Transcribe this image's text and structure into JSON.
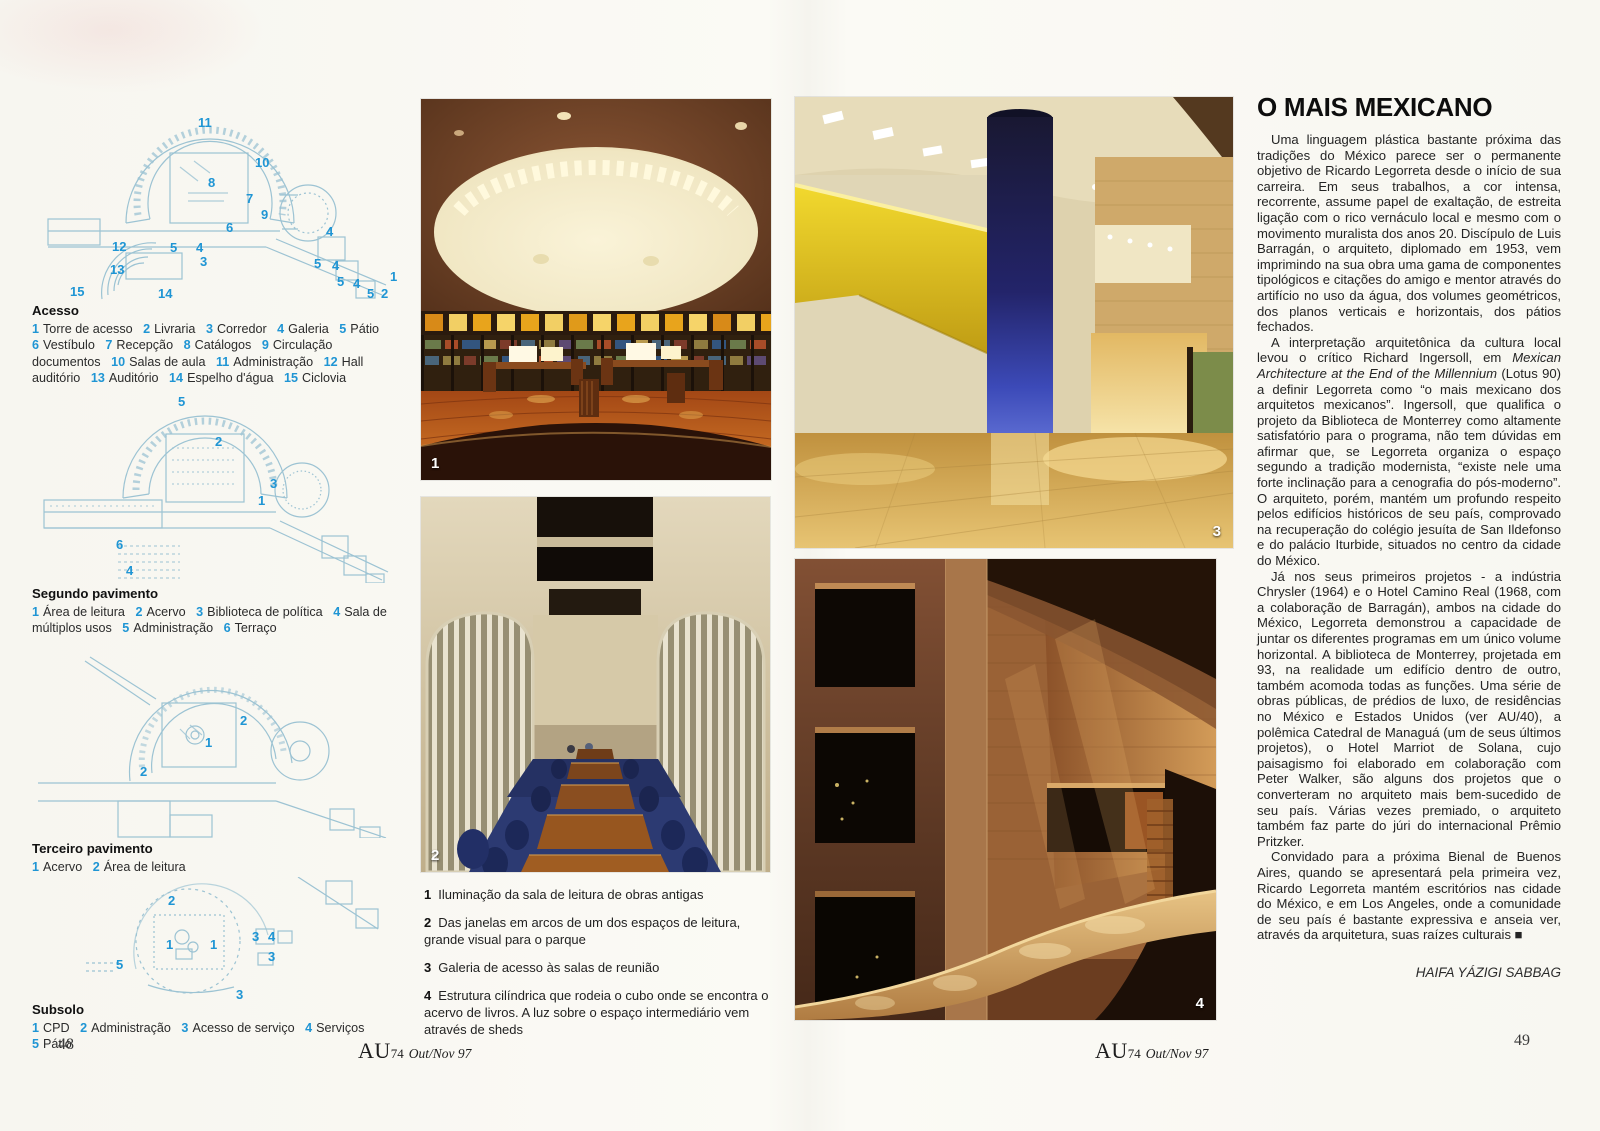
{
  "colors": {
    "legend_number_blue": "#1f95d4",
    "plan_line_blue": "#9cc3d3",
    "accent_yellow": "#e3c321",
    "column_navy": "#23246a",
    "photo_warm_floor": "#d8a75a"
  },
  "left_page": {
    "page_number": "48",
    "plans": [
      {
        "heading": "Acesso",
        "items": [
          {
            "n": "1",
            "label": "Torre de acesso"
          },
          {
            "n": "2",
            "label": "Livraria"
          },
          {
            "n": "3",
            "label": "Corredor"
          },
          {
            "n": "4",
            "label": "Galeria"
          },
          {
            "n": "5",
            "label": "Pátio"
          },
          {
            "n": "6",
            "label": "Vestíbulo"
          },
          {
            "n": "7",
            "label": "Recepção"
          },
          {
            "n": "8",
            "label": "Catálogos"
          },
          {
            "n": "9",
            "label": "Circulação documentos"
          },
          {
            "n": "10",
            "label": "Salas de aula"
          },
          {
            "n": "11",
            "label": "Administração"
          },
          {
            "n": "12",
            "label": "Hall auditório"
          },
          {
            "n": "13",
            "label": "Auditório"
          },
          {
            "n": "14",
            "label": "Espelho d'água"
          },
          {
            "n": "15",
            "label": "Ciclovia"
          }
        ],
        "markers": [
          "11",
          "10",
          "8",
          "7",
          "9",
          "6",
          "12",
          "5",
          "4",
          "3",
          "13",
          "15",
          "14",
          "4",
          "5",
          "4",
          "5",
          "4",
          "5",
          "2",
          "1"
        ]
      },
      {
        "heading": "Segundo pavimento",
        "items": [
          {
            "n": "1",
            "label": "Área de leitura"
          },
          {
            "n": "2",
            "label": "Acervo"
          },
          {
            "n": "3",
            "label": "Biblioteca de política"
          },
          {
            "n": "4",
            "label": "Sala de múltiplos usos"
          },
          {
            "n": "5",
            "label": "Administração"
          },
          {
            "n": "6",
            "label": "Terraço"
          }
        ],
        "markers": [
          "5",
          "2",
          "3",
          "1",
          "6",
          "4"
        ]
      },
      {
        "heading": "Terceiro pavimento",
        "items": [
          {
            "n": "1",
            "label": "Acervo"
          },
          {
            "n": "2",
            "label": "Área de leitura"
          }
        ],
        "markers": [
          "2",
          "1",
          "2"
        ]
      },
      {
        "heading": "Subsolo",
        "items": [
          {
            "n": "1",
            "label": "CPD"
          },
          {
            "n": "2",
            "label": "Administração"
          },
          {
            "n": "3",
            "label": "Acesso de serviço"
          },
          {
            "n": "4",
            "label": "Serviços"
          },
          {
            "n": "5",
            "label": "Pátio"
          }
        ],
        "markers": [
          "2",
          "1",
          "1",
          "3",
          "4",
          "3",
          "5",
          "3"
        ]
      }
    ],
    "photo1_label": "1",
    "photo2_label": "2",
    "captions": [
      {
        "n": "1",
        "text": "Iluminação da sala de leitura de obras antigas"
      },
      {
        "n": "2",
        "text": "Das janelas em arcos de um dos espaços de leitura, grande visual para o parque"
      },
      {
        "n": "3",
        "text": "Galeria de acesso às salas de reunião"
      },
      {
        "n": "4",
        "text": "Estrutura cilíndrica que rodeia o cubo onde se encontra o acervo de livros. A luz sobre o espaço intermediário vem através de sheds"
      }
    ],
    "footer": {
      "logo": "AU",
      "issue": "74",
      "date": "Out/Nov 97"
    }
  },
  "right_page": {
    "page_number": "49",
    "photo3_label": "3",
    "photo4_label": "4",
    "article": {
      "title": "O MAIS MEXICANO",
      "p1": "Uma linguagem plástica bastante próxima das tradições do México parece ser o permanente objetivo de Ricardo Legorreta desde o início de sua carreira. Em seus trabalhos, a cor intensa, recorrente, assume papel de exaltação, de estreita ligação com o rico vernáculo local e mesmo com o movimento muralista dos anos 20. Discípulo de Luis Barragán, o arquiteto, diplomado em 1953, vem imprimindo na sua obra uma gama de componentes tipológicos e citações do amigo e mentor através do artifício no uso da água, dos volumes geométricos, dos planos verticais e horizontais, dos pátios fechados.",
      "p2_pre": "A interpretação arquitetônica da cultura local levou o crítico Richard Ingersoll, em ",
      "p2_italic": "Mexican Architecture at the End of the Millennium",
      "p2_post": " (Lotus 90) a definir Legorreta como “o mais mexicano dos arquitetos mexicanos”. Ingersoll, que qualifica o projeto da Biblioteca de Monterrey como altamente satisfatório para o programa, não tem dúvidas em afirmar que, se Legorreta organiza o espaço segundo a tradição modernista, “existe nele uma forte inclinação para a cenografia do pós-moderno”. O arquiteto, porém, mantém um profundo respeito pelos edifícios históricos de seu país, comprovado na recuperação do colégio jesuíta de San Ildefonso e do palácio Iturbide, situados no centro da cidade do México.",
      "p3": "Já nos seus primeiros projetos - a indústria Chrysler (1964) e o Hotel Camino Real (1968, com a colaboração de Barragán), ambos na cidade do México, Legorreta demonstrou a capacidade de juntar os diferentes programas em um único volume horizontal. A biblioteca de Monterrey, projetada em 93, na realidade um edifício dentro de outro, também acomoda todas as funções. Uma série de obras públicas, de prédios de luxo, de residências no México e Estados Unidos (ver AU/40), a polêmica Catedral de Managuá (um de seus últimos projetos), o Hotel Marriot de Solana, cujo paisagismo foi elaborado em colaboração com Peter Walker, são alguns dos projetos que o converteram no arquiteto mais bem-sucedido de seu país. Várias vezes premiado, o arquiteto também faz parte do júri do internacional Prêmio Pritzker.",
      "p4": "Convidado para a próxima Bienal de Buenos Aires, quando se apresentará pela primeira vez, Ricardo Legorreta mantém escritórios nas cidade do México, e em Los Angeles, onde a comunidade de seu país é bastante expressiva e anseia ver, através da arquitetura, suas raízes culturais ■",
      "byline": "HAIFA YÁZIGI SABBAG"
    },
    "footer": {
      "logo": "AU",
      "issue": "74",
      "date": "Out/Nov 97"
    }
  }
}
